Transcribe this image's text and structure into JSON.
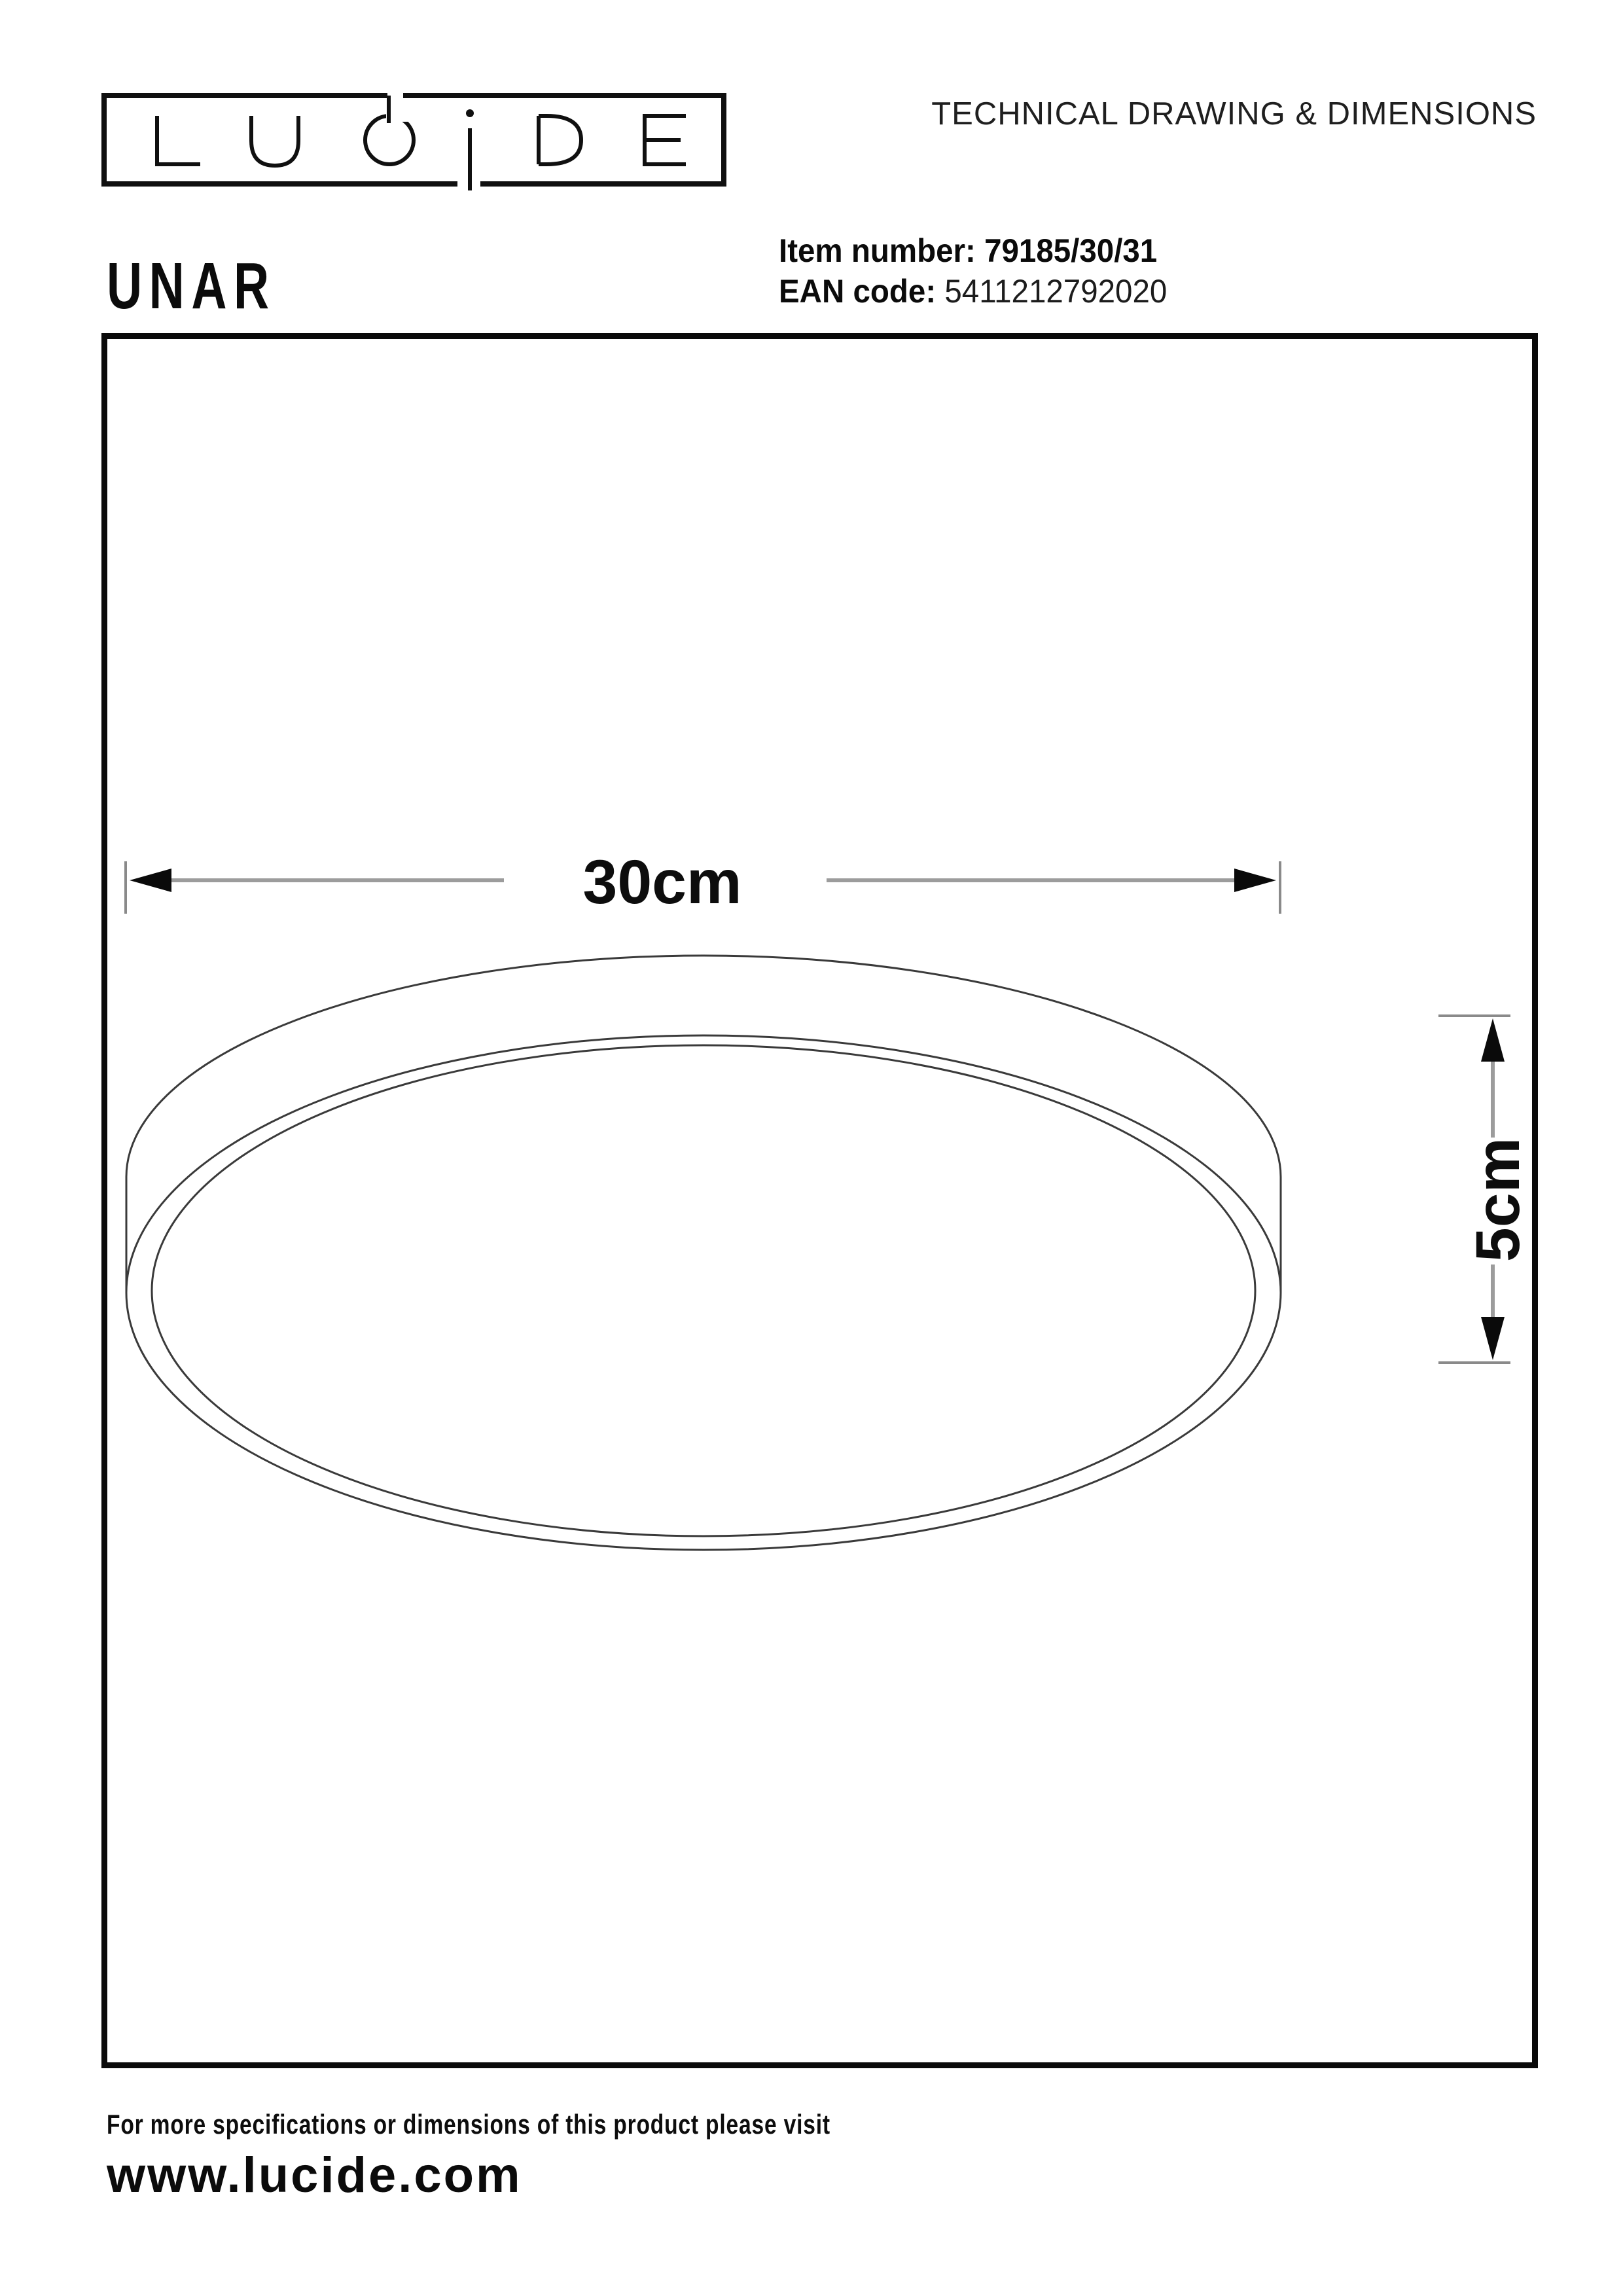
{
  "header": {
    "title": "TECHNICAL DRAWING & DIMENSIONS"
  },
  "logo": {
    "text": "LUCIDE"
  },
  "product": {
    "name": "UNAR",
    "item_number_label": "Item number:",
    "item_number_value": "79185/30/31",
    "ean_label": "EAN code:",
    "ean_value": "5411212792020"
  },
  "drawing": {
    "diameter_label": "30cm",
    "height_label": "5cm"
  },
  "footer": {
    "note": "For more specifications or dimensions of this product please visit",
    "website": "www.lucide.com"
  },
  "colors": {
    "background": "#ffffff",
    "frame": "#0a0a0a",
    "lamp_line": "#3a3a3a",
    "dim_shaft": "#9c9c9c",
    "dim_tick": "#8a8a8a",
    "arrow": "#0a0a0a",
    "text": "#101010"
  }
}
